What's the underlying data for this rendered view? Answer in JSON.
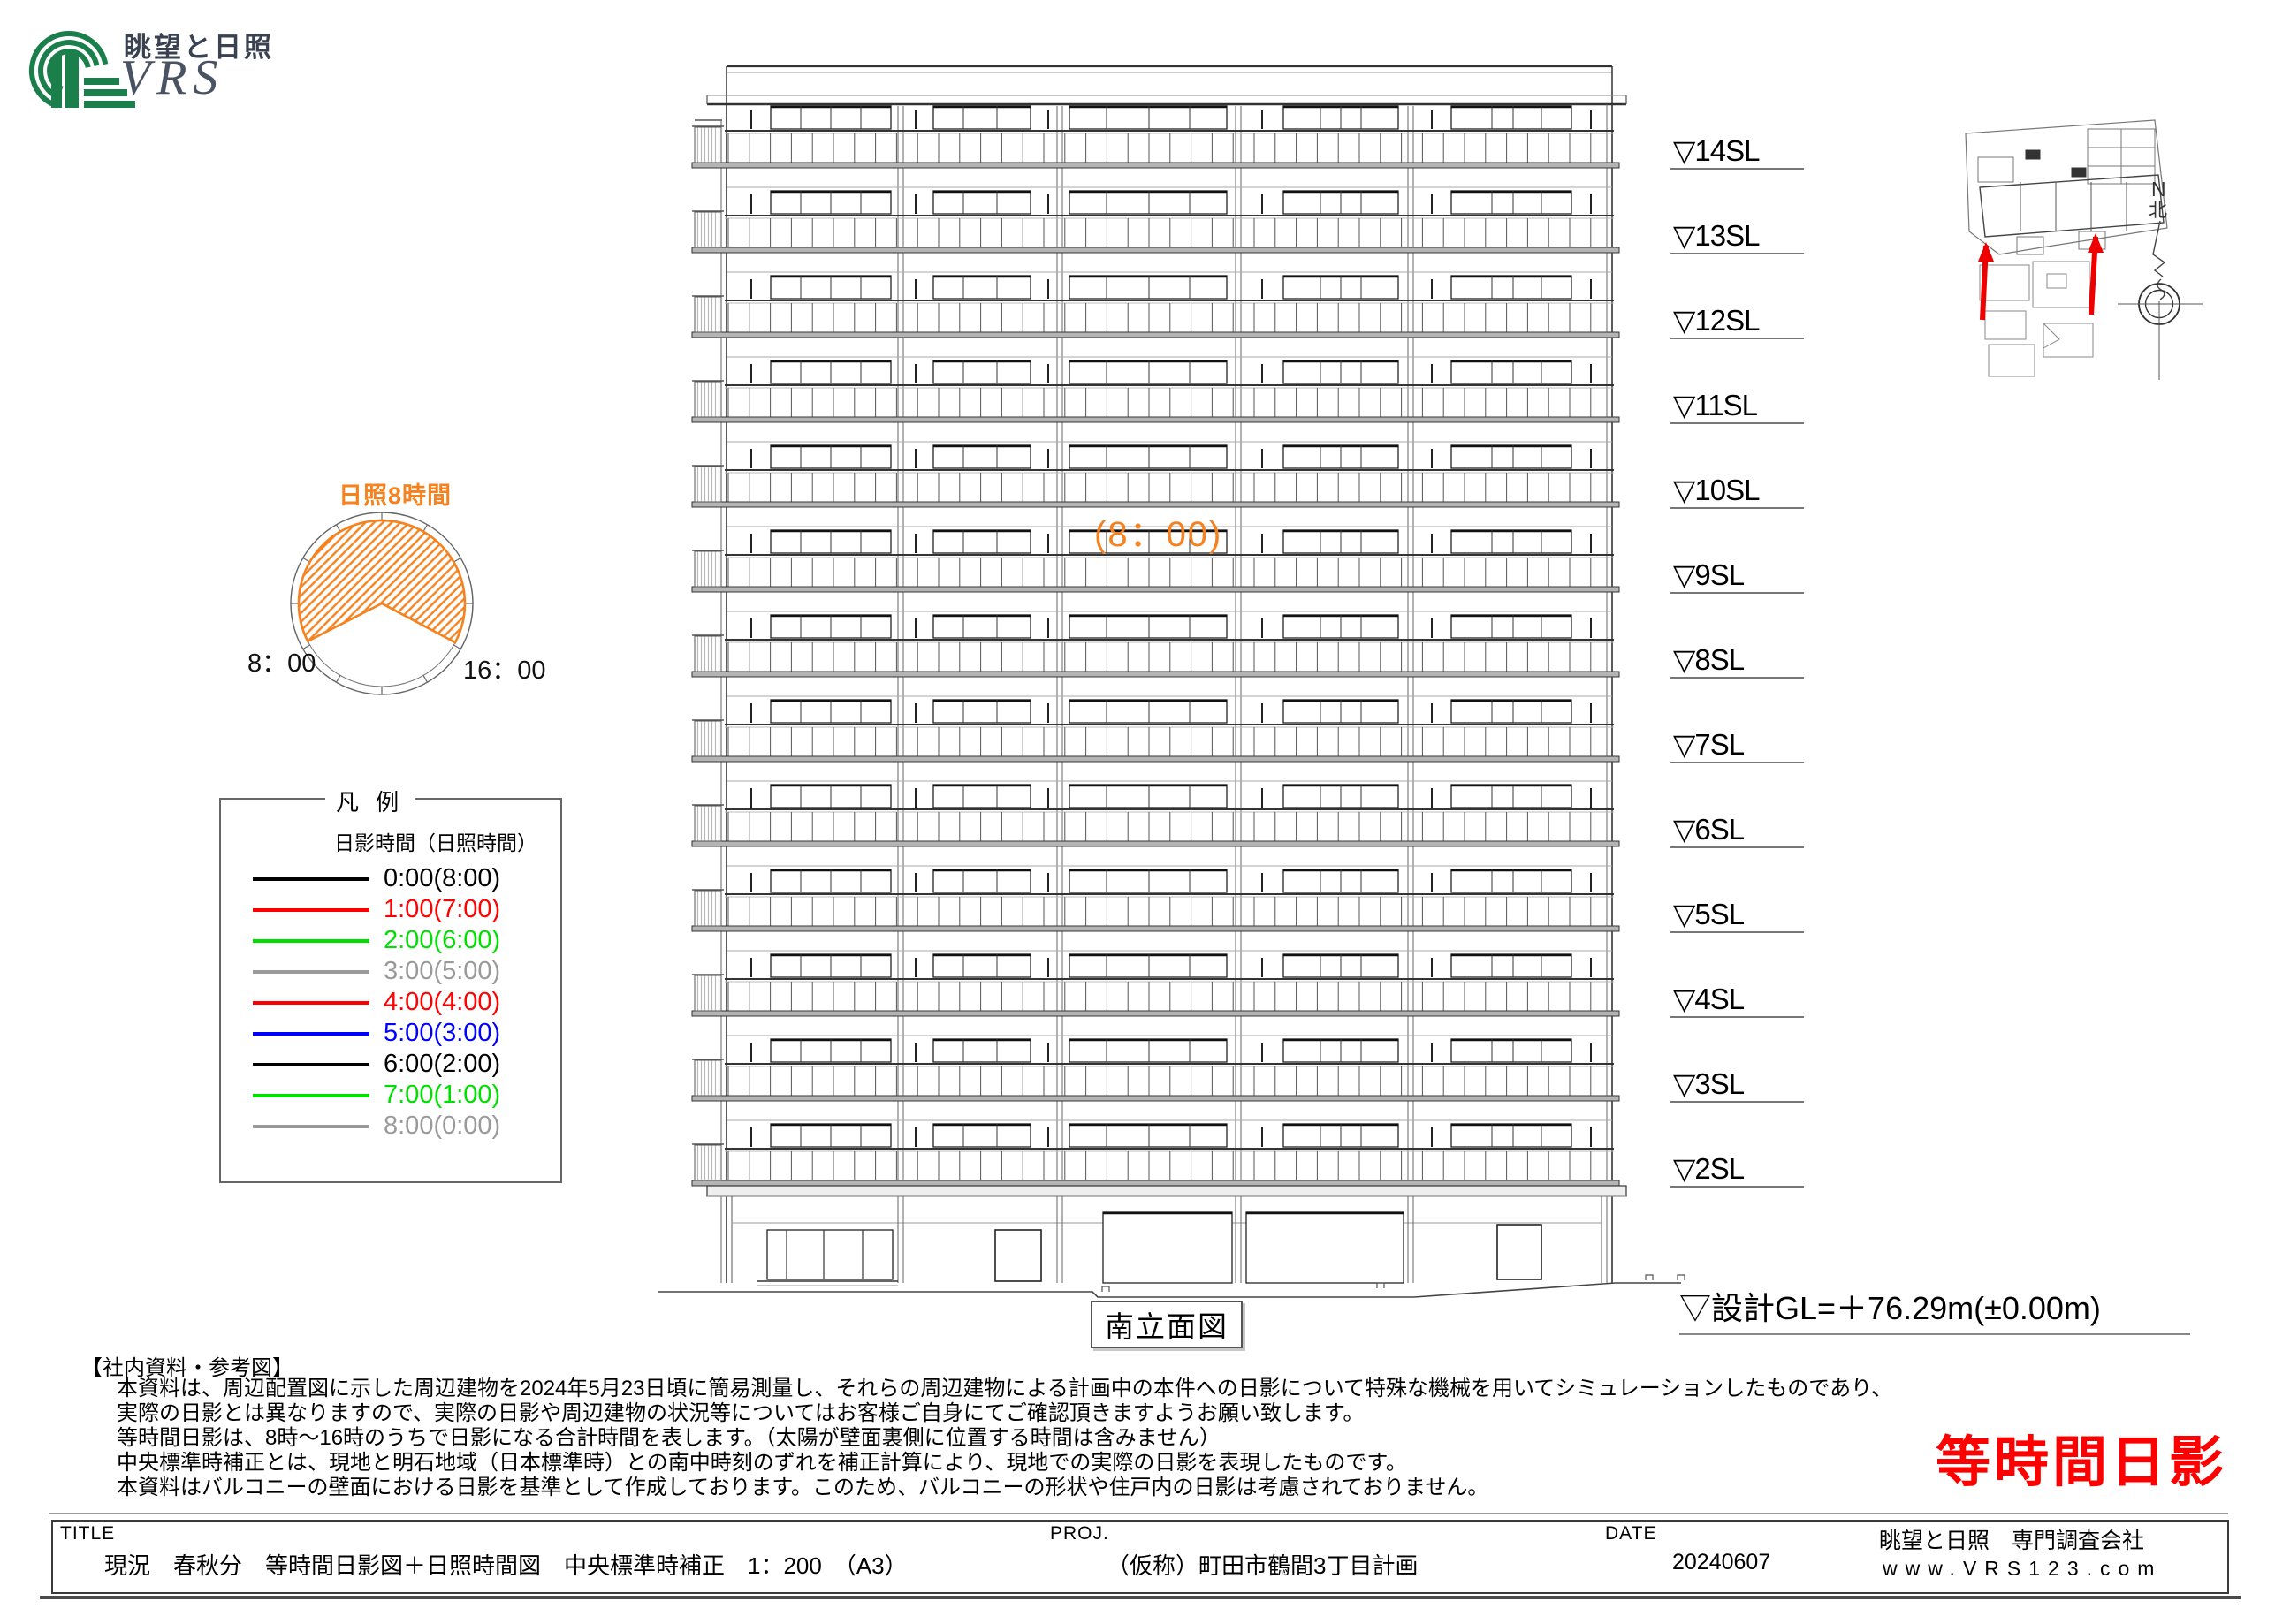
{
  "logo": {
    "brand_jp": "眺望と日照",
    "brand_en": "VRS",
    "green": "#1a7f4b",
    "text_color": "#3a4251"
  },
  "sun_diagram": {
    "title": "日照8時間",
    "start_label": "8：00",
    "end_label": "16：00",
    "orange": "#f5821f"
  },
  "legend": {
    "title": "凡 例",
    "header": "日影時間（日照時間）",
    "items": [
      {
        "label": "0:00(8:00)",
        "color": "#000000"
      },
      {
        "label": "1:00(7:00)",
        "color": "#ff0000"
      },
      {
        "label": "2:00(6:00)",
        "color": "#00e000"
      },
      {
        "label": "3:00(5:00)",
        "color": "#9a9a9a"
      },
      {
        "label": "4:00(4:00)",
        "color": "#ff0000"
      },
      {
        "label": "5:00(3:00)",
        "color": "#0000ff"
      },
      {
        "label": "6:00(2:00)",
        "color": "#000000"
      },
      {
        "label": "7:00(1:00)",
        "color": "#00e000"
      },
      {
        "label": "8:00(0:00)",
        "color": "#9a9a9a"
      }
    ]
  },
  "elevation": {
    "caption": "南立面図",
    "sun_time_annotation": "(8：00)",
    "floor_labels": [
      "▽14SL",
      "▽13SL",
      "▽12SL",
      "▽11SL",
      "▽10SL",
      "▽9SL",
      "▽8SL",
      "▽7SL",
      "▽6SL",
      "▽5SL",
      "▽4SL",
      "▽3SL",
      "▽2SL"
    ],
    "gl_label": "▽設計GL=＋76.29m(±0.00m)"
  },
  "site_plan": {
    "north_letter": "N",
    "north_kanji": "北",
    "arrow_color": "#ee0000"
  },
  "notes": {
    "heading": "【社内資料・参考図】",
    "lines": [
      "本資料は、周辺配置図に示した周辺建物を2024年5月23日頃に簡易測量し、それらの周辺建物による計画中の本件への日影について特殊な機械を用いてシミュレーションしたものであり、",
      "実際の日影とは異なりますので、実際の日影や周辺建物の状況等についてはお客様ご自身にてご確認頂きますようお願い致します。",
      "等時間日影は、8時～16時のうちで日影になる合計時間を表します。（太陽が壁面裏側に位置する時間は含みません）",
      "中央標準時補正とは、現地と明石地域（日本標準時）との南中時刻のずれを補正計算により、現地での実際の日影を表現したものです。",
      "本資料はバルコニーの壁面における日影を基準として作成しております。このため、バルコニーの形状や住戸内の日影は考慮されておりません。"
    ]
  },
  "stamp": {
    "text": "等時間日影",
    "color": "#ff0000"
  },
  "title_block": {
    "title_label": "TITLE",
    "title_value": "現況　春秋分　等時間日影図＋日照時間図　中央標準時補正　1：200　（A3）",
    "proj_label": "PROJ.",
    "proj_value": "（仮称）町田市鶴間3丁目計画",
    "date_label": "DATE",
    "date_value": "20240607",
    "company": "眺望と日照　専門調査会社",
    "website": "www.VRS123.com"
  }
}
